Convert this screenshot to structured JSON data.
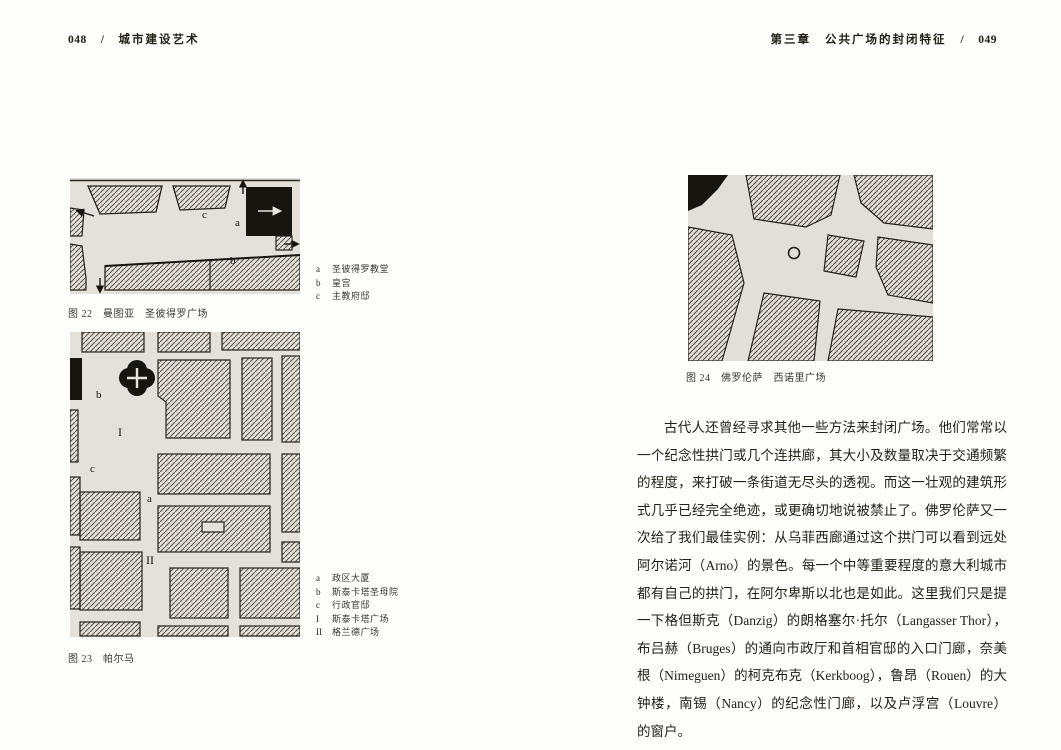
{
  "left_page": {
    "page_number": "048",
    "separator": "/",
    "book_title": "城市建设艺术",
    "figure22": {
      "caption": "图 22　曼图亚　圣彼得罗广场",
      "legend": [
        {
          "key": "a",
          "label": "圣彼得罗教堂"
        },
        {
          "key": "b",
          "label": "皇宫"
        },
        {
          "key": "c",
          "label": "主教府邸"
        }
      ]
    },
    "figure23": {
      "caption": "图 23　帕尔马",
      "legend": [
        {
          "key": "a",
          "label": "政区大厦"
        },
        {
          "key": "b",
          "label": "斯泰卡塔圣母院"
        },
        {
          "key": "c",
          "label": "行政官邸"
        },
        {
          "key": "I",
          "label": "斯泰卡塔广场"
        },
        {
          "key": "II",
          "label": "格兰德广场"
        }
      ]
    }
  },
  "right_page": {
    "chapter": "第三章",
    "chapter_title": "公共广场的封闭特征",
    "separator": "/",
    "page_number": "049",
    "figure24": {
      "caption": "图 24　佛罗伦萨　西诺里广场"
    },
    "paragraph": "古代人还曾经寻求其他一些方法来封闭广场。他们常常以一个纪念性拱门或几个连拱廊，其大小及数量取决于交通频繁的程度，来打破一条街道无尽头的透视。而这一壮观的建筑形式几乎已经完全绝迹，或更确切地说被禁止了。佛罗伦萨又一次给了我们最佳实例：从乌菲西廊通过这个拱门可以看到远处阿尔诺河（Arno）的景色。每一个中等重要程度的意大利城市都有自己的拱门，在阿尔卑斯以北也是如此。这里我们只是提一下格但斯克（Danzig）的朗格塞尔·托尔（Langasser Thor），布吕赫（Bruges）的通向市政厅和首相官邸的入口门廊，奈美根（Nimeguen）的柯克布克（Kerkboog），鲁昂（Rouen）的大钟楼，南锡（Nancy）的纪念性门廊，以及卢浮宫（Louvre）的窗户。"
  },
  "colors": {
    "map_paper": "#e4e1da",
    "map_ink": "#17150f"
  }
}
